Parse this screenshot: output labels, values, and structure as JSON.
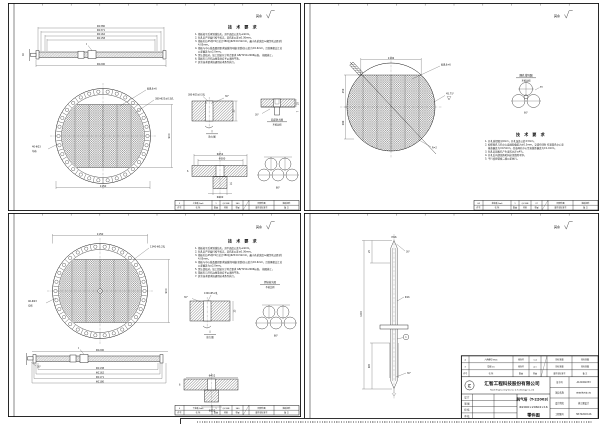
{
  "corner_mark": "其余",
  "notes_a": {
    "title": "技 术 要 求",
    "lines": [
      "1. 筛板校平后再划线钻孔，其平面度公差为≤4mm。",
      "2. 钻孔后严禁敲打校平校正，其孔距公差≤0.36mm。",
      "3. 筛板孔位45列74行总计380孔Φ25±0.52mm，最小孔桥宽度≥(相邻孔边距)的",
      "4.05mm。",
      "4. 筛板与中心线及圆周要求轴线的同轴(全跳动)公差为±0.6mm，且首尾相交汇总",
      "公差偏差为±2.0mm。",
      "5. 需认真核对，加工组装尺寸符合要求 GB/T150-2006标准。    按图施工。",
      "6. 筛板孔与开孔边缘毛刺应予以清除干净。",
      "7. 其余技术要求按通用技术条件执行。"
    ]
  },
  "notes_b": {
    "title": "技 术 要 求",
    "lines": [
      "1. 开孔直径图示6mm，开孔误差公差±3mm。",
      "2. 相邻网孔与孔中心直线距偏差为±0.3mm，交错布列时 任意管孔中心至",
      "基准偏差为±0.5mm，任意两孔中心至直线距偏差为±1.0mm。",
      "3. 钻孔后因板孔产生变形允许≤4%。",
      "4. 开孔后内部锐角毛刺必须清除干净。",
      "5. 平行度按管板二级公差执行。"
    ]
  },
  "strip_header": [
    "件号",
    "名  称",
    "数量",
    "材料",
    "重量",
    "图号或标准号",
    "备  注"
  ],
  "panels": {
    "tl": {
      "side": {
        "dims_above": [
          "Φ1380",
          "Φ1371",
          "Φ1162",
          "Φ1158"
        ],
        "dim_below": "Φ1200",
        "dim_left": "40",
        "marker": "I"
      },
      "circle": {
        "mesh_leader": "网孔6×6",
        "holes_leader": "380-Φ25±0.5孔",
        "left_label1": "40-Φ23",
        "left_label2": "均布",
        "dim_bottom": "1150",
        "dim_right": "900"
      },
      "detail1": {
        "top": "380-Φ25±0.5孔",
        "angle": "30°",
        "dim": "25",
        "name": "I",
        "scale": "放大图"
      },
      "detail2": {
        "dim1": "25",
        "dim2": "7",
        "angle": "30°",
        "name": "局部放大图",
        "scale": "不按比例"
      },
      "flange": {
        "d1": "Φ452",
        "d2": "Φ380",
        "d3": "Φ200",
        "left": "6",
        "small": "12"
      },
      "cluster_angle": "60°",
      "strip_row": [
        "2",
        "上筛板 δ=6",
        "1",
        "Q235B",
        "340",
        "同部件图",
        "筛板组件"
      ]
    },
    "tr": {
      "circle": {
        "dim_top": "1192",
        "dim_left1": "450",
        "dim_left2": "200",
        "mesh_leader": "网孔6×6",
        "angle": "45.75°",
        "flag": "1",
        "radius": "R=2"
      },
      "cluster": {
        "title": "网孔排列图",
        "scale": "不按比例",
        "angle": "60°",
        "dia": "Φ6"
      },
      "strip_row": [
        "24",
        "花纹板 δ=6",
        "1",
        "Q235B",
        "37",
        "同部件图",
        "筛板组件"
      ]
    },
    "bl": {
      "circle": {
        "holes_leader": "1340-Φ5.2孔",
        "left_label1": "40-Φ23",
        "left_label2": "均布",
        "dim_top": "1150",
        "dim_right": "900"
      },
      "weld_label": {
        "name": "焊接接头图",
        "scale": "不按比例"
      },
      "detail1": {
        "top": "1340-Φ5.2孔",
        "angle": "30°",
        "dim": "25",
        "name": "I",
        "scale": "放大图"
      },
      "cluster_angle": "60°",
      "side": {
        "dim_above": "Φ1200",
        "dims_below": [
          "Φ1138",
          "Φ1162",
          "Φ1171",
          "Φ1180"
        ],
        "marker": "I",
        "tip": "30°"
      },
      "flange": {
        "d1": "Φ452",
        "d3": "Φ252",
        "left": "6"
      },
      "strip_row": [
        "5",
        "下筛板 δ=6",
        "1",
        "Q235B",
        "340",
        "同部件图",
        "筛板组件"
      ]
    },
    "br": {
      "rod": {
        "top_label": "M16",
        "chamfer_top": "30°",
        "dia": "Φ16",
        "balloon": "1",
        "chamfer_bottom": "30°",
        "len_total": "1449",
        "len_top": "25",
        "len_bottom": "605"
      },
      "parts": {
        "rows": [
          [
            "4",
            "六角螺母 M16",
            "组合件",
            "1.4",
            "按标准图",
            "按标准图"
          ],
          [
            "3",
            "垫圈 16",
            "组合件",
            "4.1",
            "按标准图",
            "按标准图"
          ]
        ],
        "header": [
          "件号",
          "名  称",
          "数量",
          "重量",
          "图号或标准号",
          "备  注"
        ]
      },
      "company": {
        "name": "汇智工程科技股份有限公司",
        "name_en": "Huizhi Engineering Science & Technology Co.,Ltd",
        "logo": "汇"
      },
      "block": {
        "left_rows": [
          "设 计",
          "制 图",
          "校 核",
          "审 核"
        ],
        "title": "脱气塔（T-22003）",
        "spec": "Φ2000×20602×16",
        "doc_type": "零件图",
        "right_rows": [
          {
            "label": "证书号",
            "value": "A121002233"
          },
          {
            "label": "项目名称",
            "value": "脱硫系统改造工程"
          },
          {
            "label": "设计阶段",
            "value": "施工图设计"
          },
          {
            "label": "工程图号",
            "value": "HZ-T22003-06"
          }
        ]
      }
    }
  }
}
